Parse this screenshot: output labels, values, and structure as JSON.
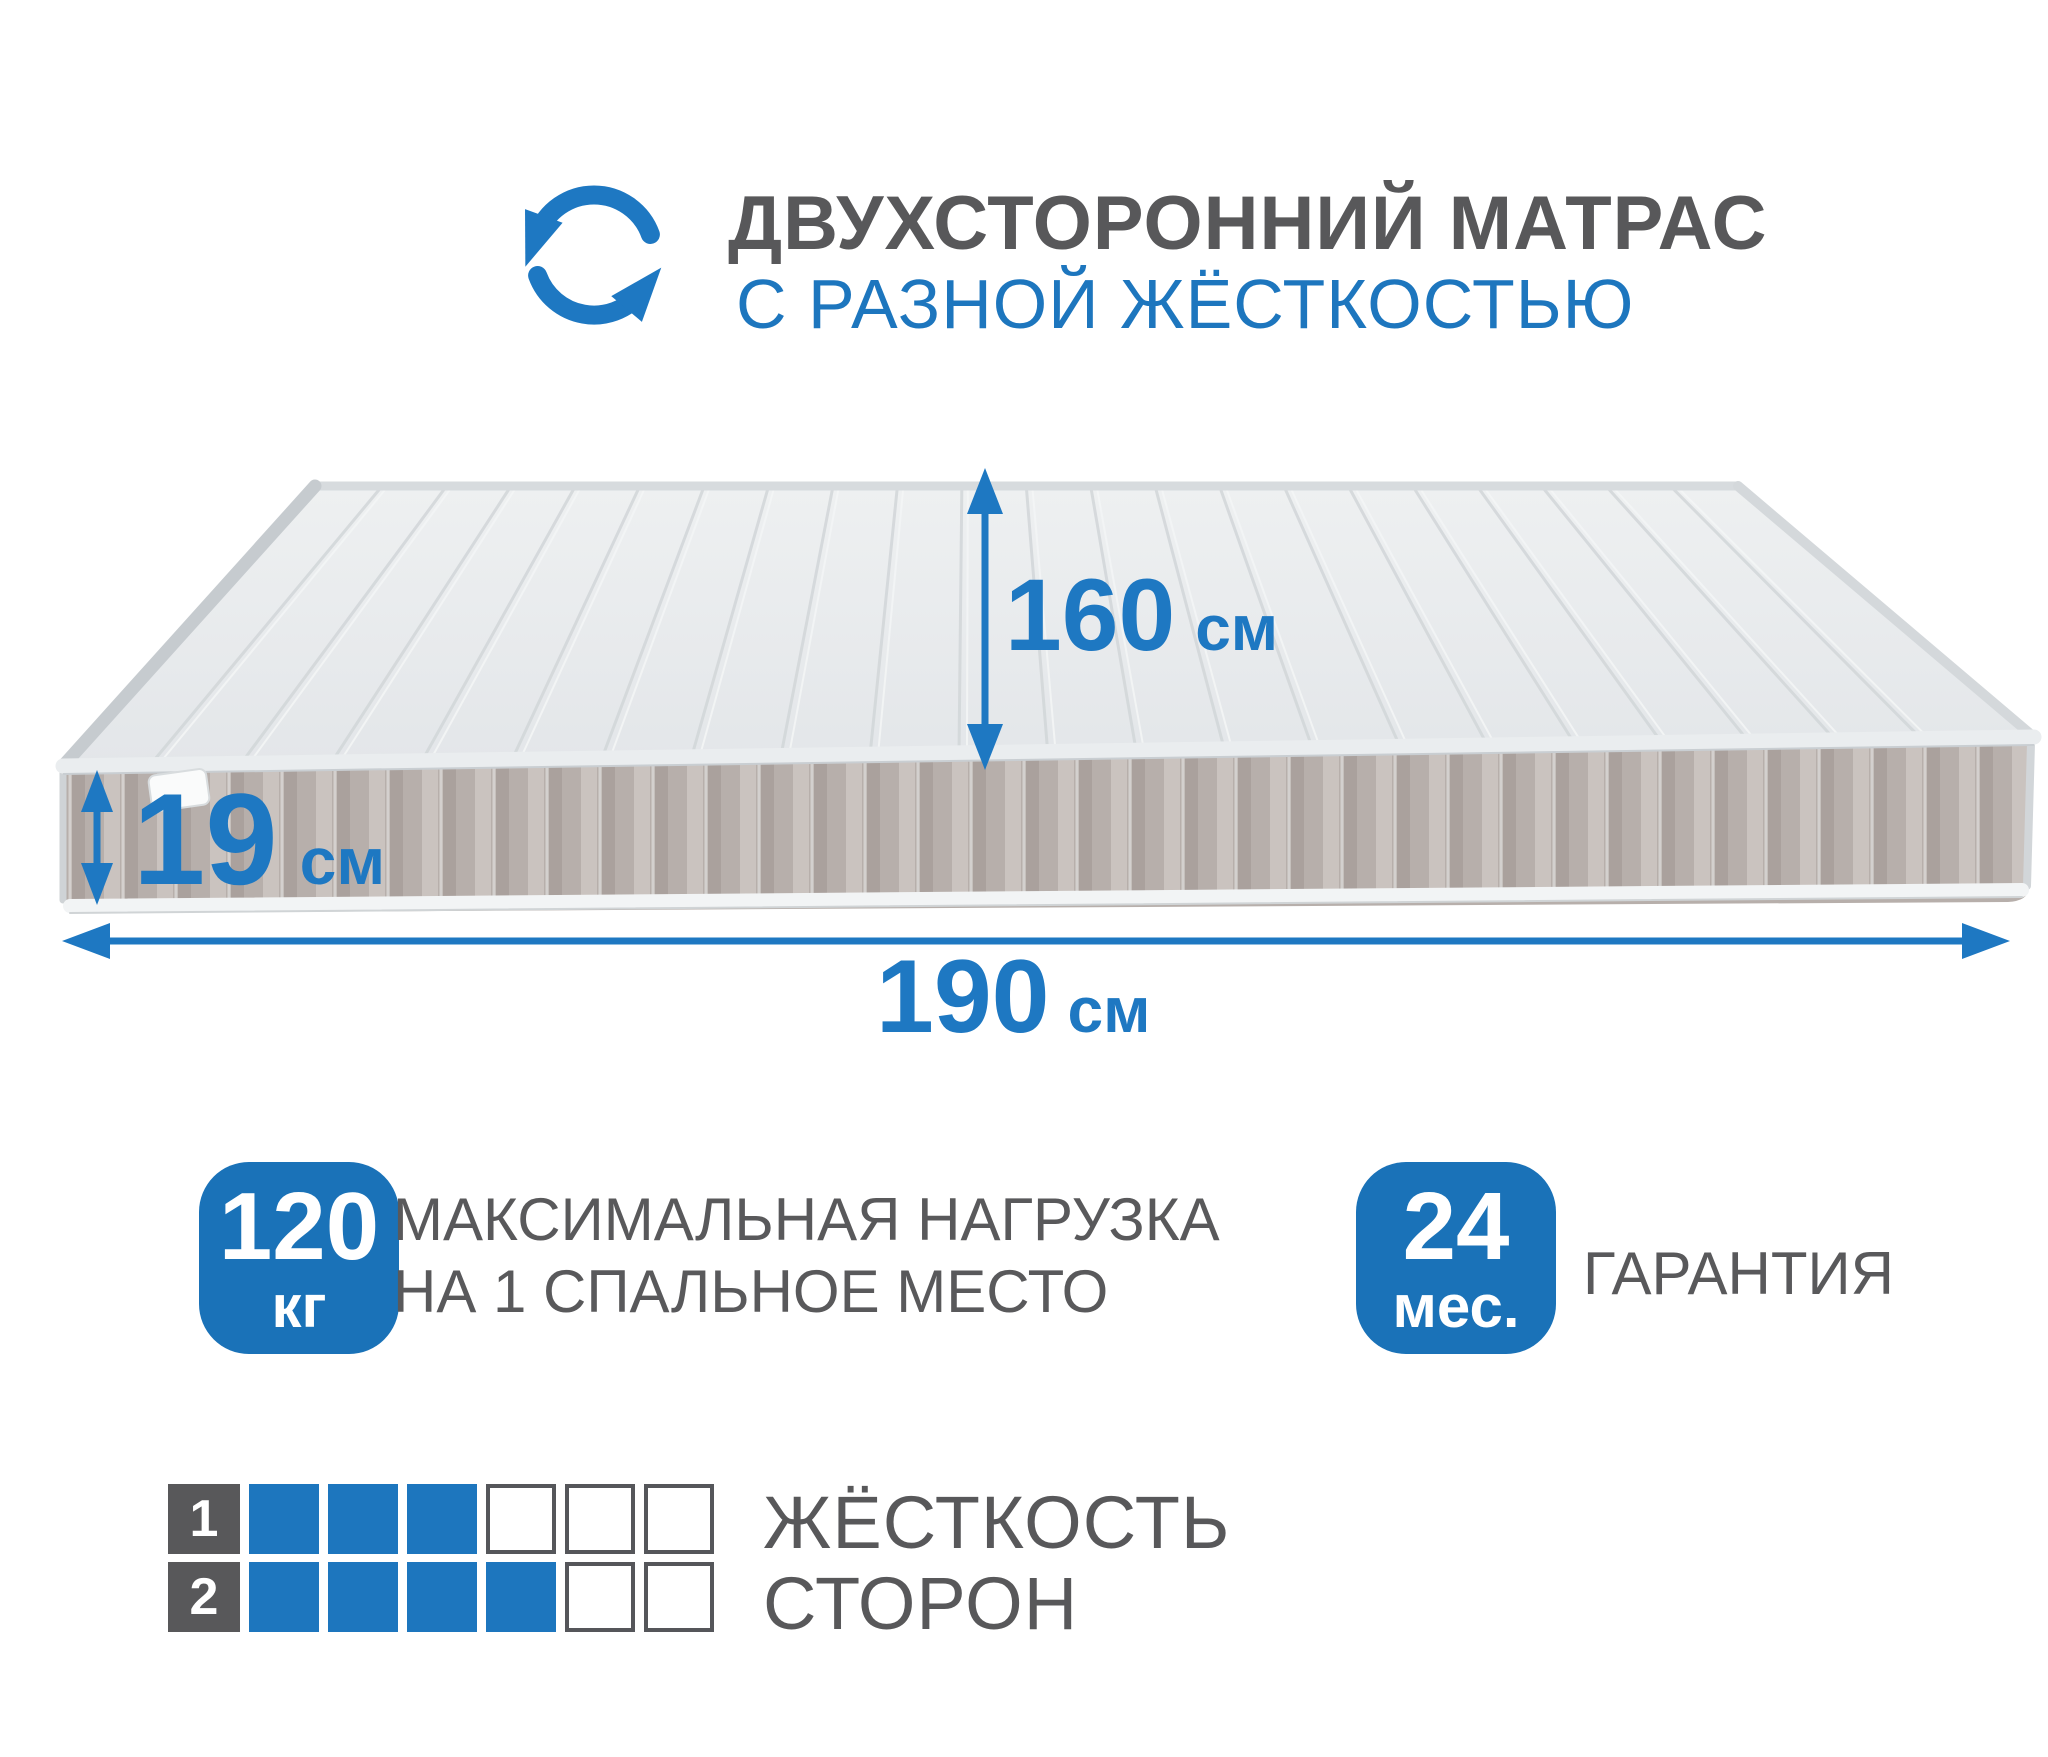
{
  "header": {
    "title": "ДВУХСТОРОННИЙ МАТРАС",
    "subtitle": "С РАЗНОЙ ЖЁСТКОСТЬЮ",
    "icon": "rotate-arrows-icon"
  },
  "dimensions": {
    "width": {
      "value": "160",
      "unit": "см"
    },
    "thickness": {
      "value": "19",
      "unit": "см"
    },
    "length": {
      "value": "190",
      "unit": "см"
    }
  },
  "badges": {
    "load": {
      "value": "120",
      "unit": "кг",
      "line1": "МАКСИМАЛЬНАЯ НАГРУЗКА",
      "line2": "НА 1 СПАЛЬНОЕ МЕСТО"
    },
    "warranty": {
      "value": "24",
      "unit": "мес.",
      "label": "ГАРАНТИЯ"
    }
  },
  "hardness": {
    "line1": "ЖЁСТКОСТЬ",
    "line2": "СТОРОН",
    "rows": [
      {
        "side": "1",
        "filled": 3,
        "total": 6
      },
      {
        "side": "2",
        "filled": 4,
        "total": 6
      }
    ]
  },
  "colors": {
    "accent_blue": "#1d76be",
    "badge_blue": "#1a72b8",
    "dark_gray": "#58585a",
    "text_gray": "#59595b",
    "mattress_top": "#e7e9eb",
    "mattress_top_stripe": "#d2d6d9",
    "mattress_top_highlight": "#f3f5f6",
    "mattress_side": "#b7afab",
    "mattress_side_dark": "#968c87",
    "mattress_side_light": "#ded8d4",
    "mattress_seam": "#d7d4d2",
    "piping_light": "#eaedef",
    "piping_edge": "#c6cbcf"
  },
  "scene": {
    "top_stripe_count": 22,
    "side_channel_step": 53
  }
}
